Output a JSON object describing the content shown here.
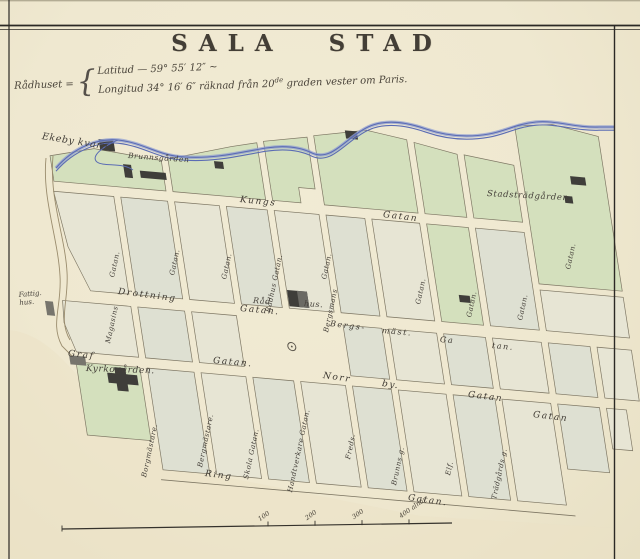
{
  "title": {
    "w1": "SALA",
    "w2": "STAD"
  },
  "coords": {
    "name": "Rådhuset =",
    "brace": "{",
    "latitud": "Latitud — 59° 55′ 12″ ~",
    "longitud_a": "Longitud 34° 16′ 6″ räknad från 20",
    "longitud_sup": "de",
    "longitud_b": " graden vester om Paris."
  },
  "places": {
    "ekeby_kvarn": "Ekeby kvarn",
    "brunnsgarden": "Brunnsgården",
    "stadstradgarden": "Stadsträdgården.",
    "kyrkogarden": "Kyrkogården.",
    "fattighus": "Fattig.\nhus.",
    "radhus_1": "Råd",
    "radhus_2": "hus."
  },
  "streets": {
    "kungs": "Kungs",
    "kungs_gatan": "Gatan",
    "drottning": "Drottning",
    "drottning_gatan": "Gatan.",
    "bergs": "Bergs-",
    "mast": "mäst.",
    "bergs_ga": "Ga",
    "bergs_tan": "tan.",
    "graf": "Graf",
    "graf_gatan": "Gatan.",
    "norr": "Norr",
    "norr_by": "by.",
    "norr_gatan": "Gatan",
    "gatan_right": "Gatan",
    "ring": "Ring",
    "ring_gatan": "Gatan."
  },
  "vstreets": {
    "v1_top": "Gatan.",
    "v1_name": "Magasins",
    "v2": "Gatan.",
    "v3": "Gatan.",
    "v4": "Rådhus Gatan.",
    "v5_top": "Gatan.",
    "v5_name": "Bergsmans",
    "v7": "Gatan.",
    "v8": "Gatan.",
    "v9": "Gatan.",
    "v10": "Gatan.",
    "b1": "Borgmästare.",
    "b2": "Bergmästare.",
    "b3": "Skola Gatan.",
    "b4": "Handtverkare Gatan.",
    "b5": "Freds.",
    "b6": "Brunns g.",
    "b7": "Elf.",
    "b8": "Trädgårds g."
  },
  "scale": {
    "t1": "100",
    "t2": "200",
    "t3": "300",
    "t4": "400 alnar"
  },
  "colors": {
    "c-paper": "#f1ebd4",
    "c-green": "#d4e0bd",
    "c-block": "#dee0d2",
    "c-pale": "#e7e5d4",
    "c-river": "#5b6cb4",
    "c-ink": "#45403a"
  }
}
